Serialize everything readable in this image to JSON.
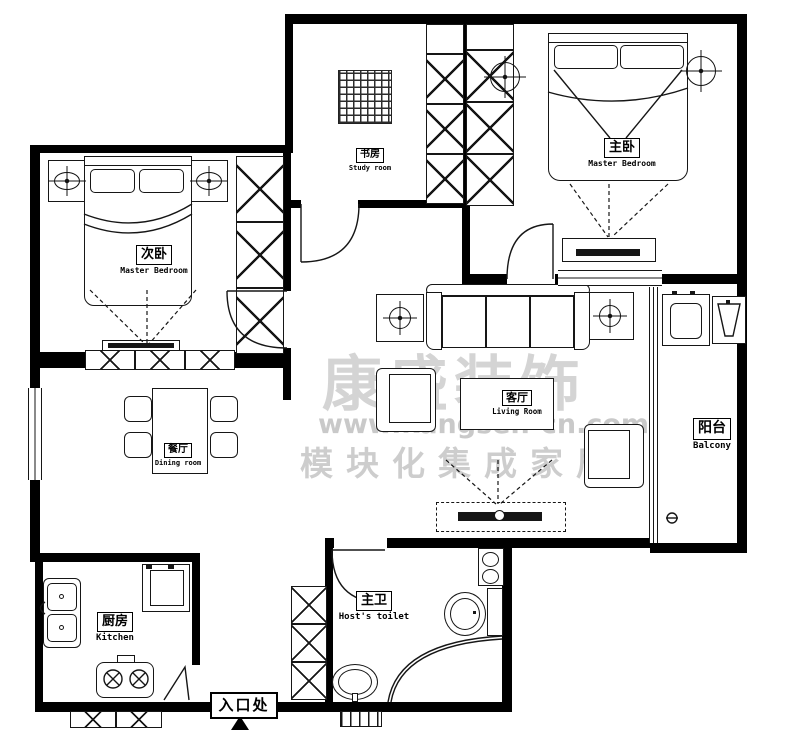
{
  "watermark": {
    "brand": "康盛装饰",
    "url": "www.kangsen-cn.com",
    "tagline": "模块化集成家居",
    "color": "#cccccc"
  },
  "rooms": {
    "bedroom2": {
      "zh": "次卧",
      "en": "Master Bedroom"
    },
    "study": {
      "zh": "书房",
      "en": "Study room"
    },
    "master": {
      "zh": "主卧",
      "en": "Master Bedroom"
    },
    "dining": {
      "zh": "餐厅",
      "en": "Dining room"
    },
    "living": {
      "zh": "客厅",
      "en": "Living Room"
    },
    "balcony": {
      "zh": "阳台",
      "en": "Balcony"
    },
    "kitchen": {
      "zh": "厨房",
      "en": "Kitchen"
    },
    "toilet": {
      "zh": "主卫",
      "en": "Host's toilet"
    },
    "entrance": {
      "zh": "入口处"
    }
  },
  "colors": {
    "wall": "#000000",
    "line": "#161616"
  }
}
